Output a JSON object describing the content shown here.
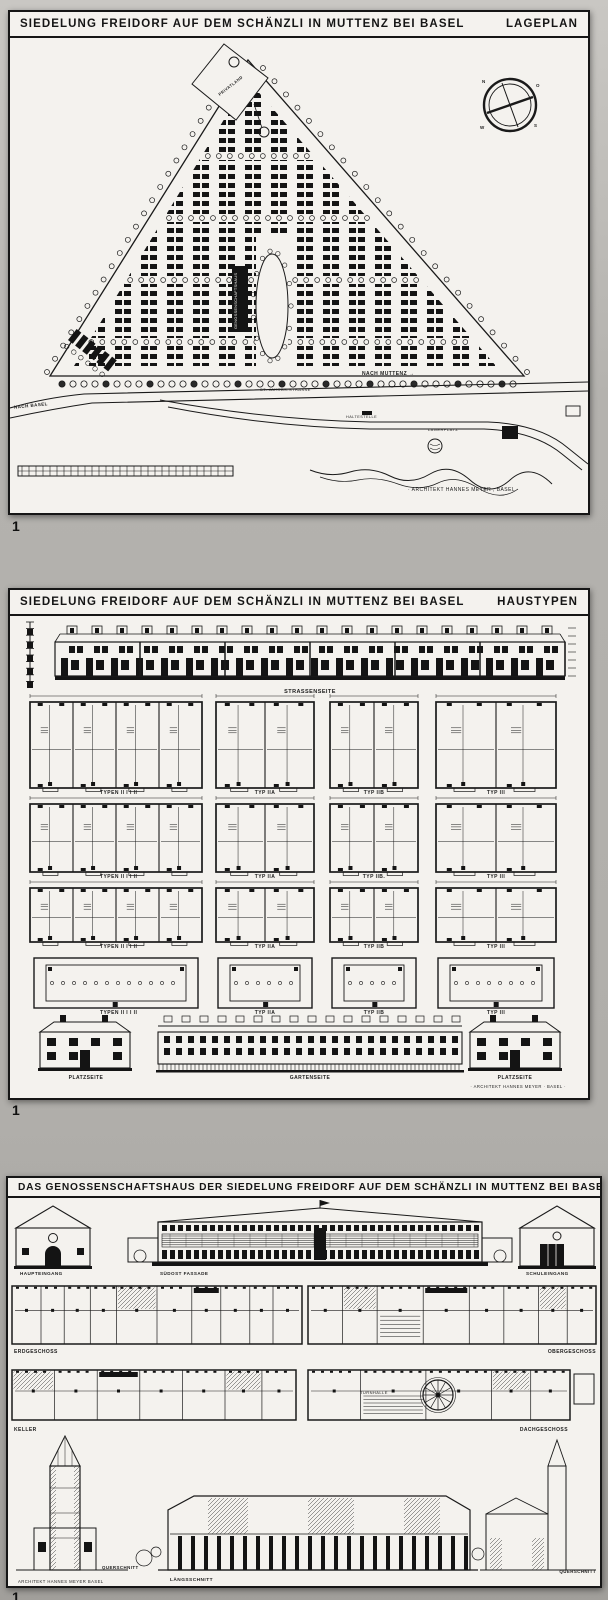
{
  "figure_markers": [
    "1",
    "1",
    "1"
  ],
  "panel1": {
    "title": "SIEDELUNG FREIDORF AUF DEM SCHÄNZLI IN MUTTENZ BEI BASEL",
    "title_right": "LAGEPLAN",
    "labels": {
      "privatland": "PRIVATLAND",
      "genossenschaftshaus": "GENOSSENSCHAFTSHAUS",
      "st_jakobstrasse": "ST. JAKOBS-STRASSE",
      "nach_muttenz": "NACH MUTTENZ →",
      "nach_basel": "NACH BASEL",
      "haltestelle": "HALTESTELLE",
      "lagerplatz": "LAGERPLATZ",
      "signature": "· ARCHITEKT HANNES MEYER , BASEL ·",
      "compass": {
        "n": "N",
        "o": "O",
        "s": "S",
        "w": "W"
      }
    }
  },
  "panel2": {
    "title": "SIEDELUNG FREIDORF AUF DEM SCHÄNZLI IN MUTTENZ BEI BASEL",
    "title_right": "HAUSTYPEN",
    "strassenseite": "STRASSENSEITE",
    "rows": [
      {
        "c1": "TYPEN II   I    I    II",
        "c2": "TYP IIA",
        "c3": "TYP IIB",
        "c4": "TYP III"
      },
      {
        "c1": "TYPEN II   I    I    II",
        "c2": "TYP IIA",
        "c3": "TYP IIB.",
        "c4": "TYP III"
      },
      {
        "c1": "TYPEN II   I    I    II",
        "c2": "TYP IIA",
        "c3": "TYP IIB",
        "c4": "TYP III"
      },
      {
        "c1": "TYPEN II   I    I    II",
        "c2": "TYP IIA",
        "c3": "TYP IIB",
        "c4": "TYP III"
      }
    ],
    "bottom": [
      "PLATZSEITE",
      "GARTENSEITE",
      "PLATZSEITE"
    ],
    "signature": "· ARCHITEKT HANNES MEYER · BASEL ·"
  },
  "panel3": {
    "title": "DAS GENOSSENSCHAFTSHAUS DER SIEDELUNG FREIDORF AUF DEM SCHÄNZLI IN MUTTENZ BEI BASEL",
    "labels": {
      "haupteingang": "HAUPTEINGANG",
      "suedost_fassade": "SÜDOST FASSADE",
      "schuleingang": "SCHULEINGANG",
      "erdgeschoss": "ERDGESCHOSS",
      "obergeschoss": "OBERGESCHOSS",
      "keller": "KELLER",
      "dachgeschoss": "DACHGESCHOSS",
      "turnhalle": "TURNHALLE",
      "querschnitt_left": "QUERSCHNITT",
      "laengsschnitt": "LÄNGSSCHNITT",
      "querschnitt_right": "QUERSCHNITT",
      "signature": "ARCHITEKT HANNES MEYER BASEL"
    }
  }
}
